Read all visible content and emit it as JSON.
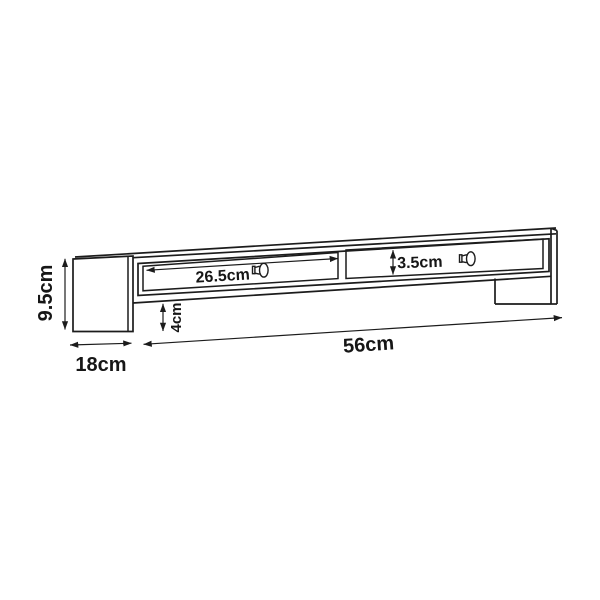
{
  "diagram": {
    "type": "furniture-dimension-drawing",
    "unit": "cm",
    "labels": {
      "height": "9.5cm",
      "depth": "18cm",
      "width": "56cm",
      "drawer_width": "26.5cm",
      "drawer_front_height": "3.5cm",
      "bottom_clearance": "4cm"
    },
    "icons": {
      "left_drawer_knob": "drawer-knob-icon",
      "right_drawer_knob": "drawer-knob-icon"
    },
    "colors": {
      "line": "#1c1c1c",
      "background": "#ffffff"
    }
  }
}
